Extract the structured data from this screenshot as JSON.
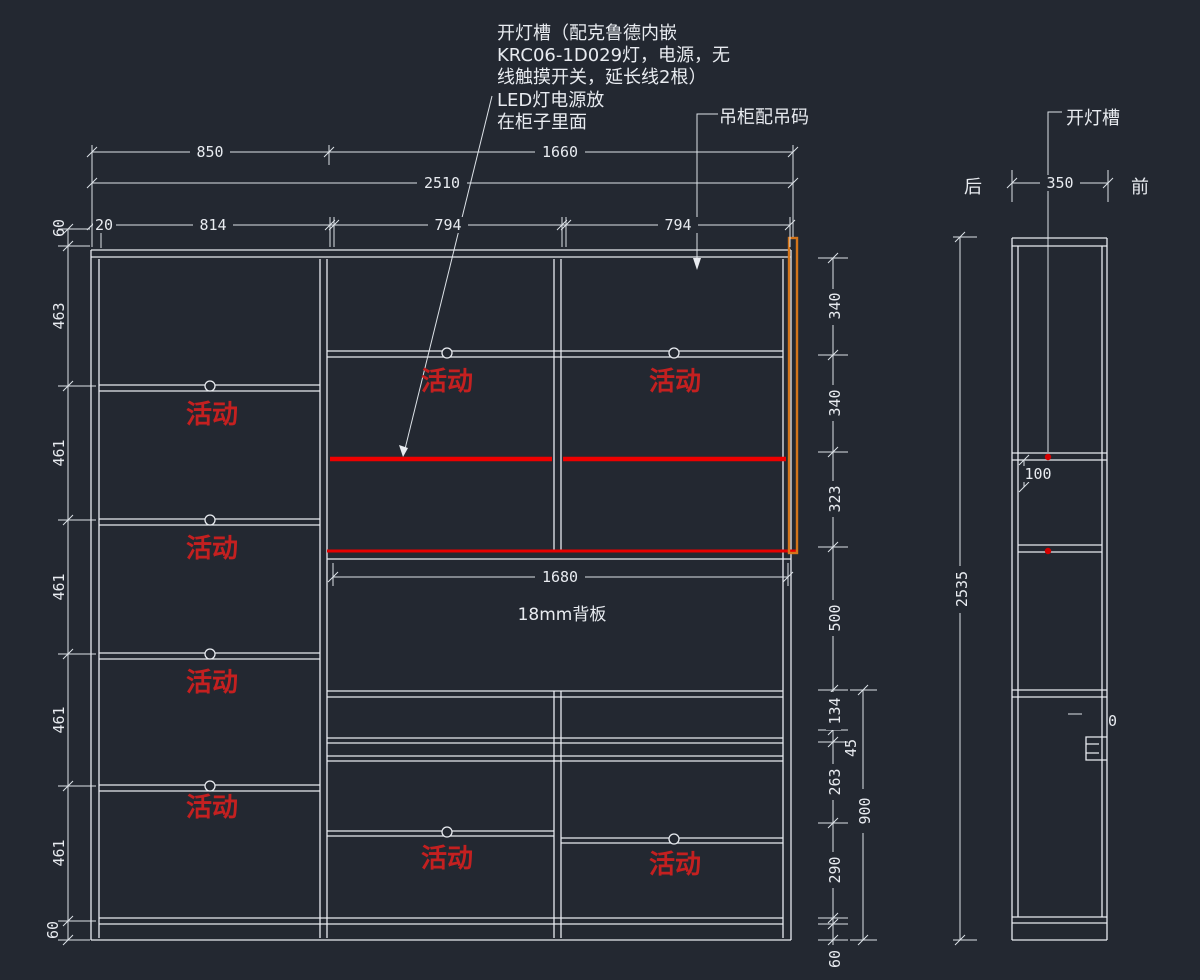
{
  "drawing": {
    "type": "cad-cabinet-elevation",
    "colors": {
      "background": "#232831",
      "line": "#e8ebf0",
      "red_text": "#c42020",
      "red_line": "#ee0000",
      "orange_rail": "#d4751b"
    }
  },
  "notes": {
    "light_slot_note": [
      "开灯槽（配克鲁德内嵌",
      "KRC06-1D029灯，电源，无",
      "线触摸开关，延长线2根）"
    ],
    "led_note": [
      "LED灯电源放",
      "在柜子里面"
    ],
    "hanging_code_note": "吊柜配吊码",
    "side_light_slot": "开灯槽",
    "back": "后",
    "front": "前",
    "backboard": "18mm背板",
    "movable": "活动",
    "zero_mark": "0"
  },
  "front_view": {
    "dims_top": {
      "w850": "850",
      "w1660": "1660",
      "w2510": "2510",
      "w20": "20",
      "w814": "814",
      "w794a": "794",
      "w794b": "794"
    },
    "dims_left": {
      "h60t": "60",
      "h463": "463",
      "h461a": "461",
      "h461b": "461",
      "h461c": "461",
      "h461d": "461",
      "h60b": "60"
    },
    "dims_right": {
      "h340a": "340",
      "h340b": "340",
      "h323": "323",
      "h500": "500",
      "h134": "134",
      "h45": "45",
      "h263": "263",
      "h290": "290",
      "h60": "60",
      "h900": "900"
    },
    "dim_1680": "1680"
  },
  "side_view": {
    "d350": "350",
    "d100": "100",
    "d2535": "2535"
  }
}
